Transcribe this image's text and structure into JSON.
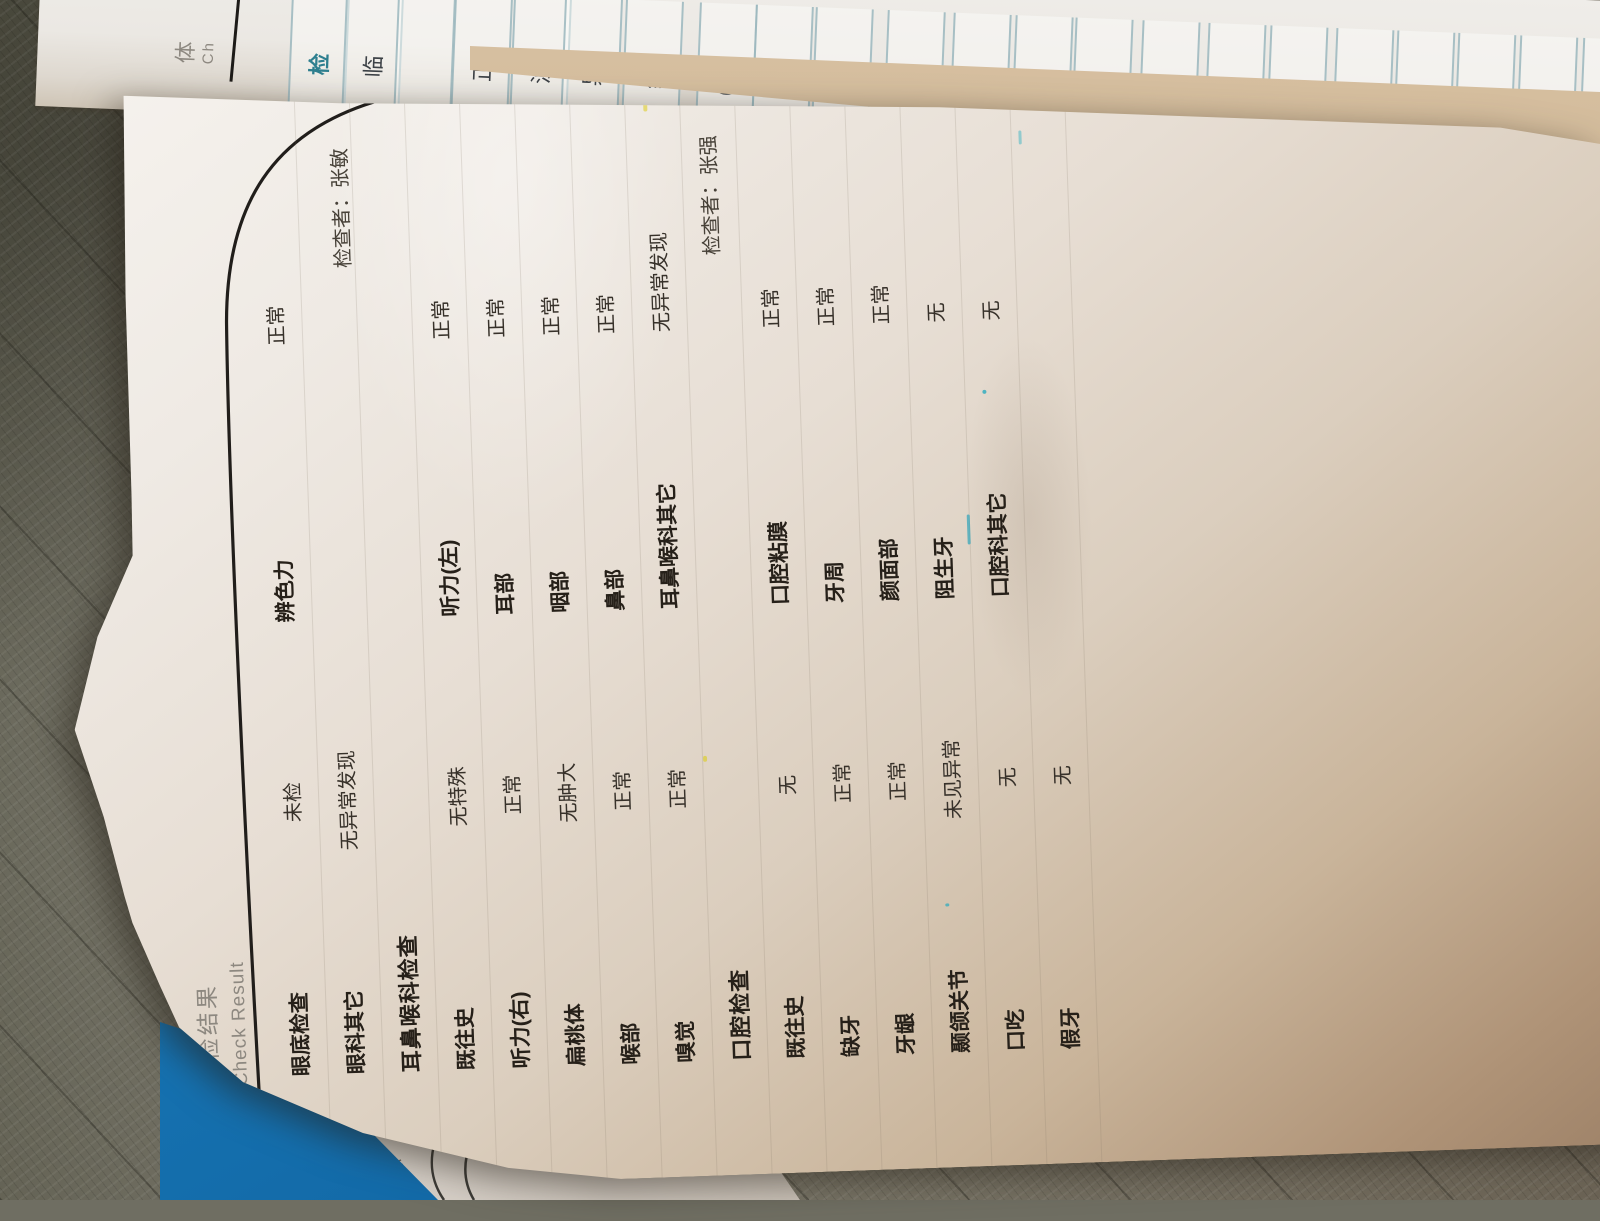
{
  "main_page": {
    "header": {
      "title_cn": "体检结果",
      "title_en": "Check Result"
    },
    "sections": [
      {
        "name": "eye",
        "header": "",
        "examiner": "",
        "rows": [
          {
            "label1": "眼底检查",
            "value1": "未检",
            "label2": "辨色力",
            "value2": "正常"
          },
          {
            "label1": "眼科其它",
            "value1": "无异常发现",
            "label2": "",
            "value2": ""
          }
        ]
      },
      {
        "name": "ent",
        "header": "耳鼻喉科检查",
        "examiner": "检查者：张敏",
        "rows": [
          {
            "label1": "既往史",
            "value1": "无特殊",
            "label2": "听力(左)",
            "value2": "正常"
          },
          {
            "label1": "听力(右)",
            "value1": "正常",
            "label2": "耳部",
            "value2": "正常"
          },
          {
            "label1": "扁桃体",
            "value1": "无肿大",
            "label2": "咽部",
            "value2": "正常"
          },
          {
            "label1": "喉部",
            "value1": "正常",
            "label2": "鼻部",
            "value2": "正常"
          },
          {
            "label1": "嗅觉",
            "value1": "正常",
            "label2": "耳鼻喉科其它",
            "value2": "无异常发现"
          }
        ]
      },
      {
        "name": "oral",
        "header": "口腔检查",
        "examiner": "检查者：张强",
        "rows": [
          {
            "label1": "既往史",
            "value1": "无",
            "label2": "口腔粘膜",
            "value2": "正常"
          },
          {
            "label1": "缺牙",
            "value1": "正常",
            "label2": "牙周",
            "value2": "正常"
          },
          {
            "label1": "牙龈",
            "value1": "正常",
            "label2": "颜面部",
            "value2": "正常"
          },
          {
            "label1": "颞颌关节",
            "value1": "未见异常",
            "label2": "阻生牙",
            "value2": "无"
          },
          {
            "label1": "口吃",
            "value1": "无",
            "label2": "口腔科其它",
            "value2": "无"
          },
          {
            "label1": "假牙",
            "value1": "无",
            "label2": "",
            "value2": ""
          }
        ]
      }
    ]
  },
  "lab_strip": {
    "cells": [
      {
        "text": "体",
        "sub": "Ch",
        "style": "plain"
      },
      {
        "text": "",
        "style": "rule"
      },
      {
        "text": "检",
        "style": "teal"
      },
      {
        "text": "临",
        "style": "box"
      },
      {
        "text": "",
        "style": "box"
      },
      {
        "text": "正",
        "style": "box"
      },
      {
        "text": "浊",
        "style": "box"
      },
      {
        "text": "异",
        "style": "box"
      },
      {
        "text": "结",
        "style": "box"
      },
      {
        "text": "(H",
        "style": "box"
      },
      {
        "text": "维",
        "style": "box"
      },
      {
        "text": "(H",
        "style": "box"
      },
      {
        "text": "尿",
        "style": "box"
      },
      {
        "text": "(H",
        "style": "box"
      },
      {
        "text": "(H",
        "style": "box"
      },
      {
        "text": "真",
        "style": "box"
      },
      {
        "text": "小",
        "style": "box"
      },
      {
        "text": "红",
        "style": "box"
      },
      {
        "text": "红细",
        "style": "red"
      },
      {
        "text": "(H",
        "style": "box"
      },
      {
        "text": "(H",
        "style": "box"
      },
      {
        "text": "(H",
        "style": "box"
      },
      {
        "text": "血小",
        "style": "box"
      },
      {
        "text": "大",
        "style": "box"
      }
    ]
  },
  "under_page": {
    "big_top": "临",
    "big_bottom": "院",
    "small_1": "年",
    "small_2": "标"
  },
  "colors": {
    "accent_teal": "#2e7f8f",
    "flag_red": "#c0392e",
    "folder_blue": "#1878b8",
    "ink": "#262019",
    "header_gray": "#8d8880",
    "carpet": "#6f6e62",
    "curl_tan": "#c3aa87"
  }
}
